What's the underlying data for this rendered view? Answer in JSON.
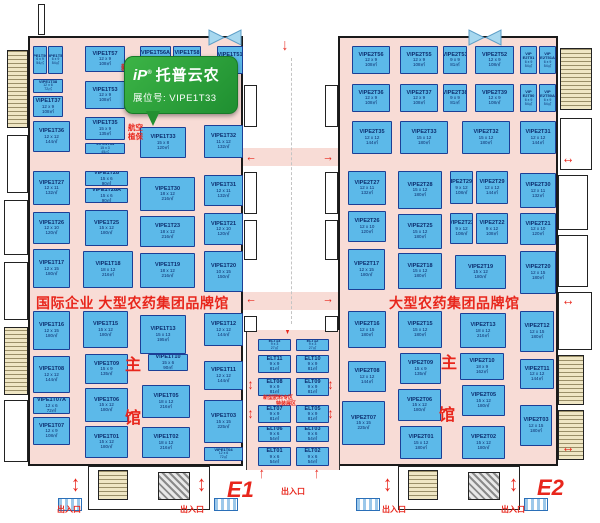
{
  "banner": {
    "logo": "iP",
    "reg": "®",
    "brand": "托普云农",
    "booth_label": "展位号:",
    "booth_no": "VIPE1T33"
  },
  "titles": {
    "e1_zone": "国际企业 大型农药集团品牌馆",
    "e2_zone": "大型农药集团品牌馆",
    "hall_e1": "E1",
    "hall_e2": "E2",
    "main_top": "主",
    "main_bottom": "馆",
    "exit": "出入口",
    "new_type_note": "新型",
    "aviation_note_1": "航空",
    "aviation_note_2": "植保",
    "elt_note_1": "新型肥料专区",
    "elt_note_2": "特装展区"
  },
  "colors": {
    "booth_fill": "#5cb9e9",
    "booth_border": "#1c3f96",
    "floor": "#f8dcd6",
    "accent_red": "#e8261c",
    "banner_green": "#2da23a"
  },
  "booths": {
    "e1": [
      {
        "id": "VIPE1T50A",
        "dim": "6 x 9",
        "area": "54㎡",
        "x": 33,
        "y": 46,
        "w": 14,
        "h": 28
      },
      {
        "id": "VIPE1T50",
        "dim": "6 x 9",
        "area": "54㎡",
        "x": 48,
        "y": 46,
        "w": 15,
        "h": 28
      },
      {
        "id": "VIPE1T57",
        "dim": "12 x 9",
        "area": "108㎡",
        "x": 85,
        "y": 46,
        "w": 40,
        "h": 26
      },
      {
        "id": "VIPE1T56A",
        "dim": "9 x 9",
        "area": "81㎡",
        "x": 140,
        "y": 46,
        "w": 31,
        "h": 25
      },
      {
        "id": "VIPE1T58",
        "dim": "9 x 9",
        "area": "81㎡",
        "x": 173,
        "y": 46,
        "w": 28,
        "h": 25
      },
      {
        "id": "VIPE1T51",
        "dim": "9 x 9",
        "area": "81㎡",
        "x": 217,
        "y": 46,
        "w": 26,
        "h": 28
      },
      {
        "id": "VIPE1T38",
        "dim": "12 x 6",
        "area": "72㎡",
        "x": 33,
        "y": 79,
        "w": 30,
        "h": 14
      },
      {
        "id": "VIPE1T53",
        "dim": "12 x 9",
        "area": "108㎡",
        "x": 85,
        "y": 81,
        "w": 40,
        "h": 28
      },
      {
        "id": "VIPE1T37",
        "dim": "12 x 9",
        "area": "108㎡",
        "x": 33,
        "y": 96,
        "w": 30,
        "h": 21
      },
      {
        "id": "VIPE1T36",
        "dim": "12 x 12",
        "area": "144㎡",
        "x": 33,
        "y": 121,
        "w": 37,
        "h": 31
      },
      {
        "id": "VIPE1T35",
        "dim": "15 x 9",
        "area": "135㎡",
        "x": 85,
        "y": 117,
        "w": 40,
        "h": 23
      },
      {
        "id": "VIPE1T34",
        "dim": "15 x 3",
        "area": "45㎡",
        "x": 85,
        "y": 143,
        "w": 40,
        "h": 11
      },
      {
        "id": "VIPE1T33",
        "dim": "15 x 8",
        "area": "120㎡",
        "x": 140,
        "y": 127,
        "w": 46,
        "h": 31
      },
      {
        "id": "VIPE1T32",
        "dim": "11 x 12",
        "area": "132㎡",
        "x": 204,
        "y": 125,
        "w": 39,
        "h": 33
      },
      {
        "id": "VIPE1T27",
        "dim": "12 x 11",
        "area": "132㎡",
        "x": 33,
        "y": 171,
        "w": 37,
        "h": 34
      },
      {
        "id": "VIPE1T28",
        "dim": "15 x 6",
        "area": "90㎡",
        "x": 85,
        "y": 171,
        "w": 43,
        "h": 15
      },
      {
        "id": "VIPE1T28A",
        "dim": "15 x 6",
        "area": "90㎡",
        "x": 85,
        "y": 188,
        "w": 43,
        "h": 15
      },
      {
        "id": "VIPE1T30",
        "dim": "18 x 12",
        "area": "216㎡",
        "x": 140,
        "y": 177,
        "w": 55,
        "h": 34
      },
      {
        "id": "VIPE1T31",
        "dim": "12 x 11",
        "area": "132㎡",
        "x": 204,
        "y": 175,
        "w": 39,
        "h": 31
      },
      {
        "id": "VIPE1T26",
        "dim": "12 x 10",
        "area": "120㎡",
        "x": 33,
        "y": 212,
        "w": 37,
        "h": 32
      },
      {
        "id": "VIPE1T25",
        "dim": "15 x 12",
        "area": "180㎡",
        "x": 85,
        "y": 210,
        "w": 43,
        "h": 36
      },
      {
        "id": "VIPE1T23",
        "dim": "18 x 12",
        "area": "216㎡",
        "x": 140,
        "y": 216,
        "w": 55,
        "h": 31
      },
      {
        "id": "VIPE1T21",
        "dim": "12 x 10",
        "area": "120㎡",
        "x": 204,
        "y": 213,
        "w": 39,
        "h": 32
      },
      {
        "id": "VIPE1T17",
        "dim": "12 x 15",
        "area": "180㎡",
        "x": 33,
        "y": 249,
        "w": 37,
        "h": 39
      },
      {
        "id": "VIPE1T18",
        "dim": "18 x 12",
        "area": "216㎡",
        "x": 83,
        "y": 251,
        "w": 50,
        "h": 37
      },
      {
        "id": "VIPE1T19",
        "dim": "18 x 12",
        "area": "216㎡",
        "x": 140,
        "y": 253,
        "w": 55,
        "h": 35
      },
      {
        "id": "VIPE1T20",
        "dim": "10 x 15",
        "area": "150㎡",
        "x": 204,
        "y": 251,
        "w": 39,
        "h": 41
      },
      {
        "id": "VIPE1T16",
        "dim": "12 x 15",
        "area": "180㎡",
        "x": 33,
        "y": 311,
        "w": 37,
        "h": 39
      },
      {
        "id": "VIPE1T15",
        "dim": "15 x 12",
        "area": "180㎡",
        "x": 83,
        "y": 311,
        "w": 45,
        "h": 37
      },
      {
        "id": "VIPE1T13",
        "dim": "15 x 13",
        "area": "195㎡",
        "x": 140,
        "y": 315,
        "w": 46,
        "h": 39
      },
      {
        "id": "VIPE1T12",
        "dim": "12 x 12",
        "area": "144㎡",
        "x": 204,
        "y": 313,
        "w": 39,
        "h": 33
      },
      {
        "id": "VIPE1T08",
        "dim": "12 x 12",
        "area": "144㎡",
        "x": 33,
        "y": 356,
        "w": 37,
        "h": 37
      },
      {
        "id": "VIPE1T09",
        "dim": "15 x 9",
        "area": "135㎡",
        "x": 85,
        "y": 354,
        "w": 43,
        "h": 30
      },
      {
        "id": "VIPE1T10",
        "dim": "15 x 6",
        "area": "90㎡",
        "x": 148,
        "y": 354,
        "w": 40,
        "h": 17
      },
      {
        "id": "VIPE1T11",
        "dim": "12 x 12",
        "area": "144㎡",
        "x": 204,
        "y": 361,
        "w": 39,
        "h": 29
      },
      {
        "id": "VIPE1T07A",
        "dim": "12 x 6",
        "area": "72㎡",
        "x": 33,
        "y": 397,
        "w": 37,
        "h": 17
      },
      {
        "id": "VIPE1T06",
        "dim": "15 x 12",
        "area": "180㎡",
        "x": 85,
        "y": 388,
        "w": 43,
        "h": 34
      },
      {
        "id": "VIPE1T05",
        "dim": "18 x 12",
        "area": "216㎡",
        "x": 142,
        "y": 385,
        "w": 48,
        "h": 33
      },
      {
        "id": "VIPE1T03",
        "dim": "15 x 15",
        "area": "225㎡",
        "x": 204,
        "y": 400,
        "w": 39,
        "h": 43
      },
      {
        "id": "VIPE1T07",
        "dim": "12 x 9",
        "area": "108㎡",
        "x": 33,
        "y": 417,
        "w": 37,
        "h": 28
      },
      {
        "id": "VIPE1T01",
        "dim": "15 x 12",
        "area": "180㎡",
        "x": 85,
        "y": 426,
        "w": 43,
        "h": 32
      },
      {
        "id": "VIPE1T02",
        "dim": "18 x 12",
        "area": "216㎡",
        "x": 142,
        "y": 427,
        "w": 48,
        "h": 31
      },
      {
        "id": "VIPE1T04",
        "dim": "12 x 6",
        "area": "72㎡",
        "x": 204,
        "y": 447,
        "w": 39,
        "h": 14
      }
    ],
    "e2": [
      {
        "id": "VIPE2T56",
        "dim": "12 x 9",
        "area": "108㎡",
        "x": 352,
        "y": 46,
        "w": 38,
        "h": 28
      },
      {
        "id": "VIPE2T55",
        "dim": "12 x 9",
        "area": "108㎡",
        "x": 400,
        "y": 46,
        "w": 38,
        "h": 28
      },
      {
        "id": "VIPE2T53",
        "dim": "9 x 9",
        "area": "81㎡",
        "x": 443,
        "y": 46,
        "w": 24,
        "h": 28
      },
      {
        "id": "VIPE2T52",
        "dim": "12 x 9",
        "area": "108㎡",
        "x": 475,
        "y": 46,
        "w": 39,
        "h": 28
      },
      {
        "id": "VIP E2T51",
        "dim": "6 x 9",
        "area": "54㎡",
        "x": 520,
        "y": 46,
        "w": 17,
        "h": 28
      },
      {
        "id": "VIP E2T51A",
        "dim": "6 x 9",
        "area": "54㎡",
        "x": 539,
        "y": 46,
        "w": 17,
        "h": 28
      },
      {
        "id": "VIPE2T36",
        "dim": "12 x 9",
        "area": "108㎡",
        "x": 352,
        "y": 84,
        "w": 38,
        "h": 28
      },
      {
        "id": "VIPE2T37",
        "dim": "12 x 9",
        "area": "108㎡",
        "x": 400,
        "y": 84,
        "w": 38,
        "h": 28
      },
      {
        "id": "VIPE2T38",
        "dim": "9 x 9",
        "area": "81㎡",
        "x": 443,
        "y": 84,
        "w": 24,
        "h": 28
      },
      {
        "id": "VIPE2T39",
        "dim": "12 x 9",
        "area": "108㎡",
        "x": 475,
        "y": 84,
        "w": 39,
        "h": 28
      },
      {
        "id": "VIP E2T50",
        "dim": "6 x 9",
        "area": "54㎡",
        "x": 520,
        "y": 84,
        "w": 17,
        "h": 28
      },
      {
        "id": "VIP E2T50A",
        "dim": "6 x 9",
        "area": "54㎡",
        "x": 539,
        "y": 84,
        "w": 17,
        "h": 28
      },
      {
        "id": "VIPE2T35",
        "dim": "12 x 12",
        "area": "144㎡",
        "x": 352,
        "y": 121,
        "w": 40,
        "h": 33
      },
      {
        "id": "VIPE2T33",
        "dim": "15 x 12",
        "area": "180㎡",
        "x": 400,
        "y": 121,
        "w": 48,
        "h": 33
      },
      {
        "id": "VIPE2T32",
        "dim": "15 x 12",
        "area": "180㎡",
        "x": 462,
        "y": 121,
        "w": 48,
        "h": 33
      },
      {
        "id": "VIPE2T31",
        "dim": "12 x 12",
        "area": "144㎡",
        "x": 520,
        "y": 121,
        "w": 36,
        "h": 33
      },
      {
        "id": "VIPE2T27",
        "dim": "12 x 11",
        "area": "132㎡",
        "x": 348,
        "y": 171,
        "w": 38,
        "h": 34
      },
      {
        "id": "VIPE2T28",
        "dim": "15 x 12",
        "area": "180㎡",
        "x": 398,
        "y": 171,
        "w": 44,
        "h": 38
      },
      {
        "id": "VIPE2T29A",
        "dim": "9 x 12",
        "area": "108㎡",
        "x": 450,
        "y": 171,
        "w": 23,
        "h": 33
      },
      {
        "id": "VIPE2T29",
        "dim": "12 x 12",
        "area": "144㎡",
        "x": 476,
        "y": 171,
        "w": 32,
        "h": 33
      },
      {
        "id": "VIPE2T30",
        "dim": "12 x 11",
        "area": "132㎡",
        "x": 520,
        "y": 173,
        "w": 36,
        "h": 35
      },
      {
        "id": "VIPE2T26",
        "dim": "12 x 10",
        "area": "120㎡",
        "x": 348,
        "y": 211,
        "w": 38,
        "h": 31
      },
      {
        "id": "VIPE2T25",
        "dim": "15 x 12",
        "area": "180㎡",
        "x": 398,
        "y": 214,
        "w": 44,
        "h": 35
      },
      {
        "id": "VIPE2T23",
        "dim": "9 x 12",
        "area": "108㎡",
        "x": 450,
        "y": 213,
        "w": 23,
        "h": 31
      },
      {
        "id": "VIPE2T22",
        "dim": "9 x 12",
        "area": "108㎡",
        "x": 476,
        "y": 213,
        "w": 32,
        "h": 31
      },
      {
        "id": "VIPE2T21",
        "dim": "12 x 10",
        "area": "120㎡",
        "x": 520,
        "y": 213,
        "w": 36,
        "h": 32
      },
      {
        "id": "VIPE2T17",
        "dim": "12 x 15",
        "area": "180㎡",
        "x": 348,
        "y": 249,
        "w": 37,
        "h": 41
      },
      {
        "id": "VIPE2T18",
        "dim": "15 x 12",
        "area": "180㎡",
        "x": 398,
        "y": 253,
        "w": 44,
        "h": 36
      },
      {
        "id": "VIPE2T19",
        "dim": "15 x 12",
        "area": "180㎡",
        "x": 455,
        "y": 255,
        "w": 51,
        "h": 34
      },
      {
        "id": "VIPE2T20",
        "dim": "12 x 15",
        "area": "180㎡",
        "x": 520,
        "y": 251,
        "w": 36,
        "h": 43
      },
      {
        "id": "VIPE2T16",
        "dim": "12 x 15",
        "area": "180㎡",
        "x": 348,
        "y": 311,
        "w": 38,
        "h": 37
      },
      {
        "id": "VIPE2T15",
        "dim": "15 x 12",
        "area": "180㎡",
        "x": 398,
        "y": 311,
        "w": 44,
        "h": 37
      },
      {
        "id": "VIPE2T13",
        "dim": "18 x 12",
        "area": "216㎡",
        "x": 460,
        "y": 313,
        "w": 46,
        "h": 35
      },
      {
        "id": "VIPE2T12",
        "dim": "12 x 15",
        "area": "180㎡",
        "x": 520,
        "y": 311,
        "w": 34,
        "h": 41
      },
      {
        "id": "VIPE2T08",
        "dim": "12 x 12",
        "area": "144㎡",
        "x": 348,
        "y": 361,
        "w": 38,
        "h": 31
      },
      {
        "id": "VIPE2T09",
        "dim": "15 x 9",
        "area": "135㎡",
        "x": 400,
        "y": 353,
        "w": 41,
        "h": 31
      },
      {
        "id": "VIPE2T10",
        "dim": "18 x 9",
        "area": "162㎡",
        "x": 460,
        "y": 353,
        "w": 44,
        "h": 27
      },
      {
        "id": "VIPE2T11",
        "dim": "12 x 12",
        "area": "144㎡",
        "x": 520,
        "y": 359,
        "w": 34,
        "h": 30
      },
      {
        "id": "VIPE2T07",
        "dim": "15 x 15",
        "area": "225㎡",
        "x": 342,
        "y": 401,
        "w": 43,
        "h": 44
      },
      {
        "id": "VIPE2T06",
        "dim": "15 x 12",
        "area": "180㎡",
        "x": 398,
        "y": 389,
        "w": 43,
        "h": 32
      },
      {
        "id": "VIPE2T05",
        "dim": "15 x 12",
        "area": "180㎡",
        "x": 462,
        "y": 385,
        "w": 43,
        "h": 31
      },
      {
        "id": "VIPE2T03",
        "dim": "12 x 15",
        "area": "180㎡",
        "x": 520,
        "y": 405,
        "w": 32,
        "h": 41
      },
      {
        "id": "VIPE2T01",
        "dim": "15 x 12",
        "area": "180㎡",
        "x": 400,
        "y": 426,
        "w": 42,
        "h": 33
      },
      {
        "id": "VIPE2T02",
        "dim": "15 x 12",
        "area": "180㎡",
        "x": 462,
        "y": 426,
        "w": 43,
        "h": 33
      }
    ],
    "elt": [
      {
        "id": "ELT13",
        "dim": "9 x 3",
        "area": "27㎡",
        "x": 258,
        "y": 339,
        "w": 33,
        "h": 12
      },
      {
        "id": "ELT12",
        "dim": "9 x 3",
        "area": "27㎡",
        "x": 296,
        "y": 339,
        "w": 33,
        "h": 12
      },
      {
        "id": "ELT11",
        "dim": "9 x 9",
        "area": "81㎡",
        "x": 258,
        "y": 355,
        "w": 33,
        "h": 18
      },
      {
        "id": "ELT10",
        "dim": "9 x 9",
        "area": "81㎡",
        "x": 296,
        "y": 355,
        "w": 33,
        "h": 18
      },
      {
        "id": "ELT08",
        "dim": "9 x 9",
        "area": "81㎡",
        "x": 258,
        "y": 378,
        "w": 33,
        "h": 18
      },
      {
        "id": "ELT09",
        "dim": "9 x 9",
        "area": "81㎡",
        "x": 296,
        "y": 378,
        "w": 33,
        "h": 18
      },
      {
        "id": "ELT07",
        "dim": "9 x 9",
        "area": "81㎡",
        "x": 258,
        "y": 405,
        "w": 33,
        "h": 18
      },
      {
        "id": "ELT05",
        "dim": "9 x 9",
        "area": "81㎡",
        "x": 296,
        "y": 405,
        "w": 33,
        "h": 18
      },
      {
        "id": "ELT06",
        "dim": "9 x 6",
        "area": "54㎡",
        "x": 258,
        "y": 426,
        "w": 33,
        "h": 16
      },
      {
        "id": "ELT03",
        "dim": "9 x 6",
        "area": "54㎡",
        "x": 296,
        "y": 426,
        "w": 33,
        "h": 16
      },
      {
        "id": "ELT01",
        "dim": "9 x 6",
        "area": "54㎡",
        "x": 258,
        "y": 447,
        "w": 33,
        "h": 19
      },
      {
        "id": "ELT02",
        "dim": "9 x 6",
        "area": "54㎡",
        "x": 296,
        "y": 447,
        "w": 33,
        "h": 19
      }
    ]
  }
}
